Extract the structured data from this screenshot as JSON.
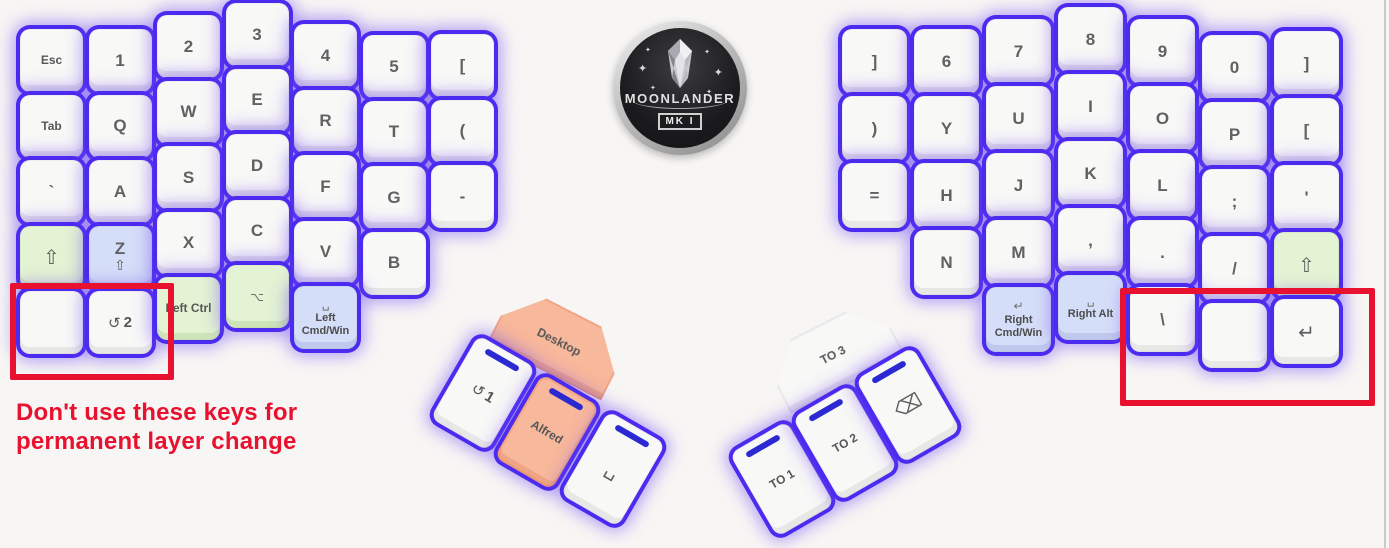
{
  "canvas": {
    "width": 1389,
    "height": 548,
    "background": "#f7f6f4"
  },
  "colors": {
    "glow_accent": "#4b2bef",
    "annotation_red": "#e8112f",
    "key_green": "#e3f3d3",
    "key_blue": "#d5def8",
    "key_orange": "#f8b89b",
    "led_blue": "#2b2ad2"
  },
  "logo": {
    "title": "MOONLANDER",
    "badge": "MK I"
  },
  "annotation": {
    "warning_line1": "Don't use these keys for",
    "warning_line2": "permanent layer change"
  },
  "left_half": {
    "keys": [
      {
        "name": "esc",
        "col": 0,
        "row": 0,
        "variant": "name",
        "text": "Esc"
      },
      {
        "name": "1",
        "col": 1,
        "row": 0,
        "variant": "glyph",
        "text": "1"
      },
      {
        "name": "2",
        "col": 2,
        "row": 0,
        "variant": "glyph",
        "text": "2"
      },
      {
        "name": "3",
        "col": 3,
        "row": 0,
        "variant": "glyph",
        "text": "3"
      },
      {
        "name": "4",
        "col": 4,
        "row": 0,
        "variant": "glyph",
        "text": "4"
      },
      {
        "name": "5",
        "col": 5,
        "row": 0,
        "variant": "glyph",
        "text": "5"
      },
      {
        "name": "open-bracket",
        "col": 6,
        "row": 0,
        "variant": "glyph",
        "text": "["
      },
      {
        "name": "tab",
        "col": 0,
        "row": 1,
        "variant": "name",
        "text": "Tab"
      },
      {
        "name": "q",
        "col": 1,
        "row": 1,
        "variant": "glyph",
        "text": "Q"
      },
      {
        "name": "w",
        "col": 2,
        "row": 1,
        "variant": "glyph",
        "text": "W"
      },
      {
        "name": "e",
        "col": 3,
        "row": 1,
        "variant": "glyph",
        "text": "E"
      },
      {
        "name": "r",
        "col": 4,
        "row": 1,
        "variant": "glyph",
        "text": "R"
      },
      {
        "name": "t",
        "col": 5,
        "row": 1,
        "variant": "glyph",
        "text": "T"
      },
      {
        "name": "open-paren",
        "col": 6,
        "row": 1,
        "variant": "glyph",
        "text": "("
      },
      {
        "name": "backtick",
        "col": 0,
        "row": 2,
        "variant": "glyph",
        "text": "`"
      },
      {
        "name": "a",
        "col": 1,
        "row": 2,
        "variant": "glyph",
        "text": "A"
      },
      {
        "name": "s",
        "col": 2,
        "row": 2,
        "variant": "glyph",
        "text": "S"
      },
      {
        "name": "d",
        "col": 3,
        "row": 2,
        "variant": "glyph",
        "text": "D"
      },
      {
        "name": "f",
        "col": 4,
        "row": 2,
        "variant": "glyph",
        "text": "F"
      },
      {
        "name": "g",
        "col": 5,
        "row": 2,
        "variant": "glyph",
        "text": "G"
      },
      {
        "name": "minus",
        "col": 6,
        "row": 2,
        "variant": "glyph",
        "text": "-"
      },
      {
        "name": "left-shift",
        "col": 0,
        "row": 3,
        "variant": "icon",
        "icon": "⇧",
        "icon_name": "shift-icon",
        "color": "green"
      },
      {
        "name": "z-hold-shift",
        "col": 1,
        "row": 3,
        "variant": "combo",
        "text": "Z",
        "icon": "⇧",
        "icon_name": "shift-icon",
        "color": "blue"
      },
      {
        "name": "x",
        "col": 2,
        "row": 3,
        "variant": "glyph",
        "text": "X"
      },
      {
        "name": "c",
        "col": 3,
        "row": 3,
        "variant": "glyph",
        "text": "C"
      },
      {
        "name": "v",
        "col": 4,
        "row": 3,
        "variant": "glyph",
        "text": "V"
      },
      {
        "name": "b",
        "col": 5,
        "row": 3,
        "variant": "glyph",
        "text": "B"
      },
      {
        "name": "blank-left",
        "col": 0,
        "row": 4,
        "variant": "blank"
      },
      {
        "name": "toggle-layer-2",
        "col": 1,
        "row": 4,
        "variant": "layer",
        "icon": "↺",
        "icon_name": "layer-toggle-icon",
        "text": "2"
      },
      {
        "name": "left-ctrl",
        "col": 2,
        "row": 4,
        "variant": "name",
        "text": "Left Ctrl",
        "color": "green"
      },
      {
        "name": "left-option",
        "col": 3,
        "row": 4,
        "variant": "iconsm",
        "icon": "⌥",
        "icon_name": "option-icon",
        "color": "green"
      },
      {
        "name": "left-cmd-win",
        "col": 4,
        "row": 4,
        "variant": "mod",
        "icon": "␣",
        "icon_name": "space-icon",
        "lines": [
          "Left",
          "Cmd/Win"
        ],
        "color": "blue"
      }
    ]
  },
  "right_half": {
    "keys": [
      {
        "name": "close-bracket-inner",
        "col": 0,
        "row": 0,
        "variant": "glyph",
        "text": "]"
      },
      {
        "name": "6",
        "col": 1,
        "row": 0,
        "variant": "glyph",
        "text": "6"
      },
      {
        "name": "7",
        "col": 2,
        "row": 0,
        "variant": "glyph",
        "text": "7"
      },
      {
        "name": "8",
        "col": 3,
        "row": 0,
        "variant": "glyph",
        "text": "8"
      },
      {
        "name": "9",
        "col": 4,
        "row": 0,
        "variant": "glyph",
        "text": "9"
      },
      {
        "name": "0",
        "col": 5,
        "row": 0,
        "variant": "glyph",
        "text": "0"
      },
      {
        "name": "close-bracket-outer",
        "col": 6,
        "row": 0,
        "variant": "glyph",
        "text": "]"
      },
      {
        "name": "close-paren",
        "col": 0,
        "row": 1,
        "variant": "glyph",
        "text": ")"
      },
      {
        "name": "y",
        "col": 1,
        "row": 1,
        "variant": "glyph",
        "text": "Y"
      },
      {
        "name": "u",
        "col": 2,
        "row": 1,
        "variant": "glyph",
        "text": "U"
      },
      {
        "name": "i",
        "col": 3,
        "row": 1,
        "variant": "glyph",
        "text": "I"
      },
      {
        "name": "o",
        "col": 4,
        "row": 1,
        "variant": "glyph",
        "text": "O"
      },
      {
        "name": "p",
        "col": 5,
        "row": 1,
        "variant": "glyph",
        "text": "P"
      },
      {
        "name": "open-bracket-right",
        "col": 6,
        "row": 1,
        "variant": "glyph",
        "text": "["
      },
      {
        "name": "equals",
        "col": 0,
        "row": 2,
        "variant": "glyph",
        "text": "="
      },
      {
        "name": "h",
        "col": 1,
        "row": 2,
        "variant": "glyph",
        "text": "H"
      },
      {
        "name": "j",
        "col": 2,
        "row": 2,
        "variant": "glyph",
        "text": "J"
      },
      {
        "name": "k",
        "col": 3,
        "row": 2,
        "variant": "glyph",
        "text": "K"
      },
      {
        "name": "l",
        "col": 4,
        "row": 2,
        "variant": "glyph",
        "text": "L"
      },
      {
        "name": "semicolon",
        "col": 5,
        "row": 2,
        "variant": "glyph",
        "text": ";"
      },
      {
        "name": "quote",
        "col": 6,
        "row": 2,
        "variant": "glyph",
        "text": "'"
      },
      {
        "name": "n",
        "col": 1,
        "row": 3,
        "variant": "glyph",
        "text": "N"
      },
      {
        "name": "m",
        "col": 2,
        "row": 3,
        "variant": "glyph",
        "text": "M"
      },
      {
        "name": "comma",
        "col": 3,
        "row": 3,
        "variant": "glyph",
        "text": ","
      },
      {
        "name": "period",
        "col": 4,
        "row": 3,
        "variant": "glyph",
        "text": "."
      },
      {
        "name": "slash",
        "col": 5,
        "row": 3,
        "variant": "glyph",
        "text": "/"
      },
      {
        "name": "right-shift",
        "col": 6,
        "row": 3,
        "variant": "icon",
        "icon": "⇧",
        "icon_name": "shift-icon",
        "color": "green"
      },
      {
        "name": "right-cmd-win",
        "col": 2,
        "row": 4,
        "variant": "mod",
        "icon": "↵",
        "icon_name": "enter-icon",
        "lines": [
          "Right",
          "Cmd/Win"
        ],
        "color": "blue"
      },
      {
        "name": "right-alt",
        "col": 3,
        "row": 4,
        "variant": "mod",
        "icon": "␣",
        "icon_name": "space-icon",
        "lines": [
          "Right Alt"
        ],
        "color": "blue"
      },
      {
        "name": "backslash",
        "col": 4,
        "row": 4,
        "variant": "glyph",
        "text": "\\"
      },
      {
        "name": "blank-right",
        "col": 5,
        "row": 4,
        "variant": "blank"
      },
      {
        "name": "enter",
        "col": 6,
        "row": 4,
        "variant": "icon",
        "icon": "↵",
        "icon_name": "enter-icon"
      }
    ]
  },
  "left_thumb": {
    "keys": [
      {
        "name": "desktop",
        "slot": "hex",
        "variant": "name",
        "text": "Desktop",
        "color": "orange"
      },
      {
        "name": "toggle-layer-1",
        "slot": "p0",
        "variant": "layer",
        "icon": "↺",
        "icon_name": "layer-toggle-icon",
        "text": "1",
        "led": true
      },
      {
        "name": "alfred",
        "slot": "p1",
        "variant": "name",
        "text": "Alfred",
        "color": "orange",
        "led": true
      },
      {
        "name": "space",
        "slot": "p2",
        "variant": "icon",
        "icon": "␣",
        "icon_name": "space-icon",
        "led": true
      }
    ]
  },
  "right_thumb": {
    "keys": [
      {
        "name": "to-layer-3",
        "slot": "hex",
        "variant": "name",
        "text": "TO 3"
      },
      {
        "name": "to-layer-1",
        "slot": "p0",
        "variant": "name",
        "text": "TO 1",
        "led": true
      },
      {
        "name": "to-layer-2",
        "slot": "p1",
        "variant": "name",
        "text": "TO 2",
        "led": true
      },
      {
        "name": "backspace",
        "slot": "p2",
        "variant": "icon",
        "icon": "⌫",
        "icon_name": "backspace-icon",
        "led": true
      }
    ]
  }
}
